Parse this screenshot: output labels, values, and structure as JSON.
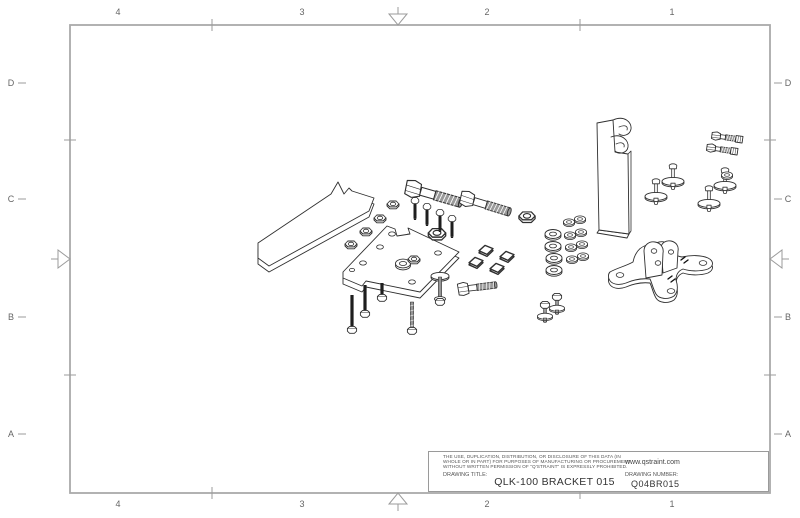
{
  "frame": {
    "columns": [
      "4",
      "3",
      "2",
      "1"
    ],
    "rows": [
      "D",
      "C",
      "B",
      "A"
    ]
  },
  "title_block": {
    "legal": [
      "THE USE, DUPLICATION, DISTRIBUTION, OR DISCLOSURE OF THIS DATA (IN",
      "WHOLE OR IN PART) FOR PURPOSES OF MANUFACTURING OR PROCUREMENT",
      "WITHOUT WRITTEN PERMISSION OF \"Q'STRAINT\" IS EXPRESSLY PROHIBITED."
    ],
    "website": "www.qstraint.com",
    "title_label": "DRAWING TITLE:",
    "title": "QLK-100 BRACKET 015",
    "number_label": "DRAWING NUMBER:",
    "number": "Q04BR015"
  },
  "components": [
    {
      "name": "stabilizer-plate",
      "qty": 1
    },
    {
      "name": "mounting-plate",
      "qty": 1
    },
    {
      "name": "hex-flange-nut-small",
      "qty": 4
    },
    {
      "name": "hex-flange-nut-large",
      "qty": 2
    },
    {
      "name": "carriage-bolt-dark",
      "qty": 7
    },
    {
      "name": "hex-bolt-large",
      "qty": 2
    },
    {
      "name": "hex-bolt-short",
      "qty": 1
    },
    {
      "name": "square-nut",
      "qty": 4
    },
    {
      "name": "flat-washer-large",
      "qty": 4
    },
    {
      "name": "flat-washer-small",
      "qty": 9
    },
    {
      "name": "flange-bolt-with-washer",
      "qty": 3
    },
    {
      "name": "j-hook-bracket",
      "qty": 1
    },
    {
      "name": "anchor-pin-with-disc",
      "qty": 4
    },
    {
      "name": "small-bolt-with-locknut",
      "qty": 2
    },
    {
      "name": "cross-base-plate-with-clevis",
      "qty": 1
    }
  ],
  "colors": {
    "frame_line": "#aaaaaa",
    "line": "#2f2f2f",
    "dark_fastener": "#1e1e1e",
    "thread_gray": "#9a9a9a",
    "label_text": "#666666",
    "title_text": "#333333"
  }
}
